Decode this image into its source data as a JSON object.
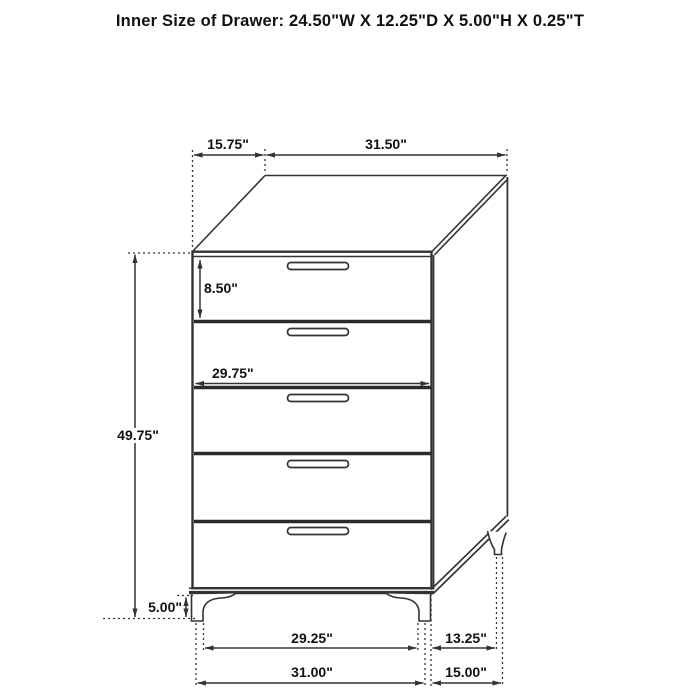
{
  "title": "Inner Size of Drawer: 24.50\"W X 12.25\"D X 5.00\"H X 0.25\"T",
  "figure": {
    "description": "Dimension line drawing of a 5-drawer chest shown in three-quarter view",
    "drawer_count": 5
  },
  "dimensions": {
    "top_depth": "15.75\"",
    "top_width": "31.50\"",
    "top_drawer_height": "8.50\"",
    "front_inner_width": "29.75\"",
    "body_height": "49.75\"",
    "leg_height": "5.00\"",
    "front_leg_inner_span": "29.25\"",
    "side_leg_span": "13.25\"",
    "overall_width": "31.00\"",
    "overall_depth": "15.00\""
  },
  "colors": {
    "line": "#333333",
    "text": "#111111",
    "background": "#ffffff"
  }
}
